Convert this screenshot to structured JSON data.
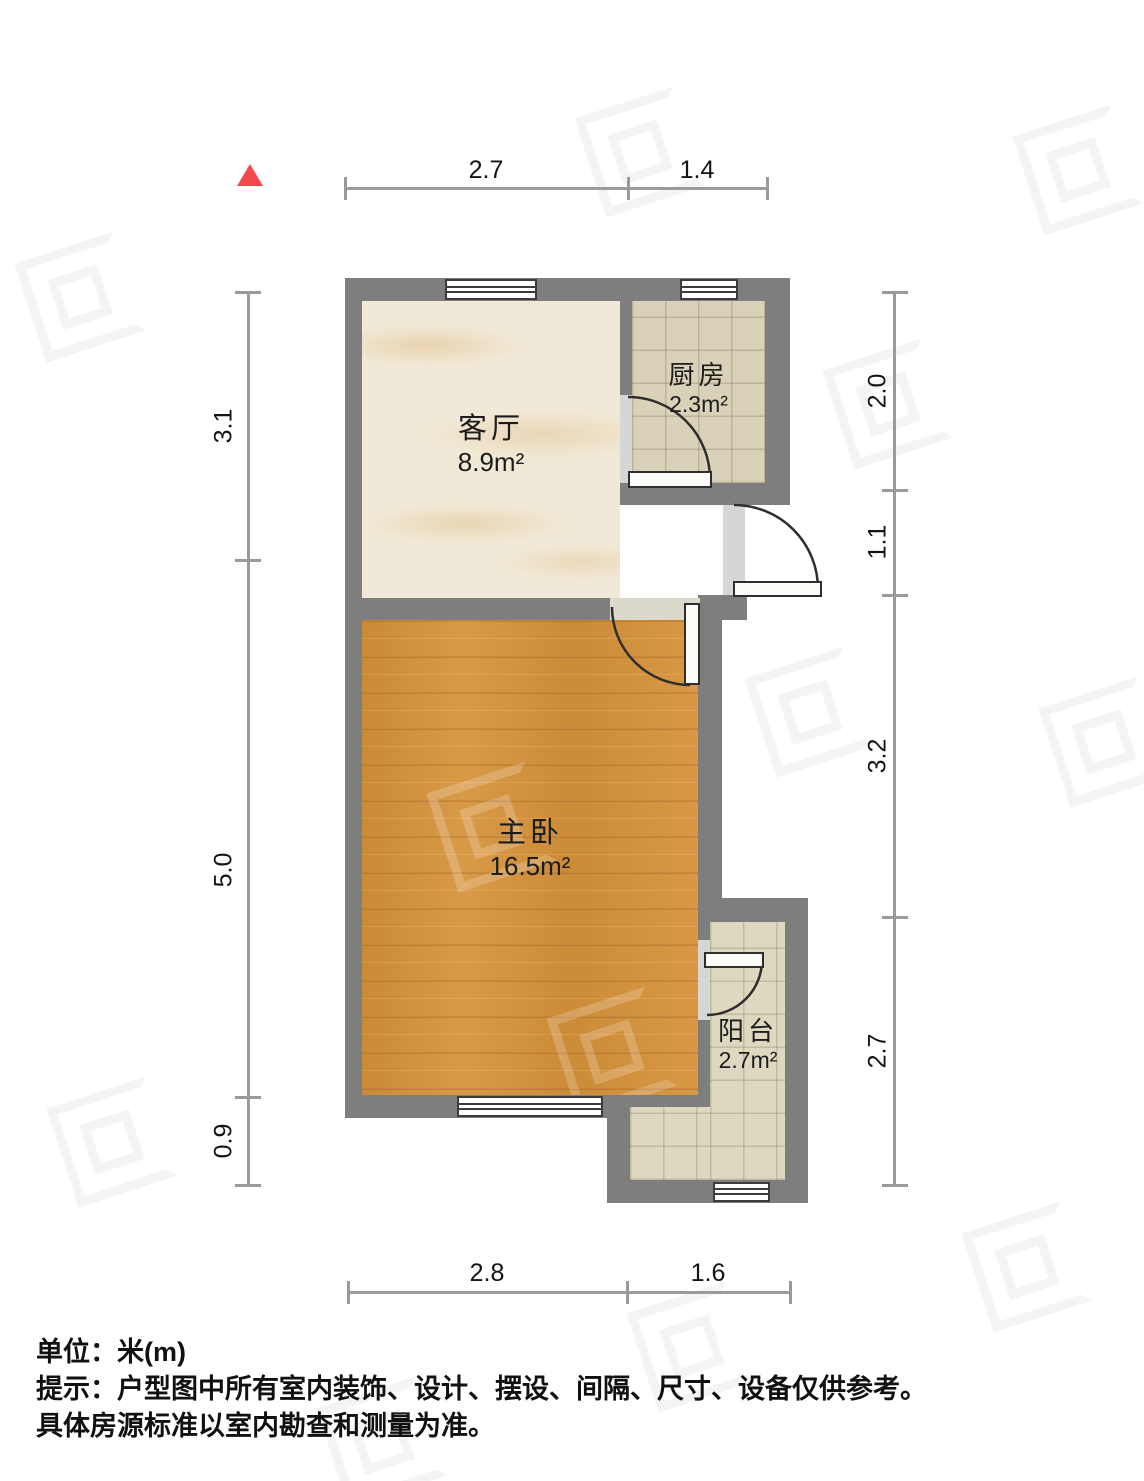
{
  "plan": {
    "rooms": {
      "living": {
        "name": "客厅",
        "area": "8.9m²"
      },
      "kitchen": {
        "name": "厨房",
        "area": "2.3m²"
      },
      "bedroom": {
        "name": "主卧",
        "area": "16.5m²"
      },
      "balcony": {
        "name": "阳台",
        "area": "2.7m²"
      }
    },
    "dims": {
      "top": [
        "2.7",
        "1.4"
      ],
      "bottom": [
        "2.8",
        "1.6"
      ],
      "left": [
        "3.1",
        "5.0",
        "0.9"
      ],
      "right": [
        "2.0",
        "1.1",
        "3.2",
        "2.7"
      ]
    },
    "colors": {
      "wall": "#7e7e7e",
      "dimension_line": "#9a9a9a",
      "north_arrow": "#f2484b",
      "living_floor": "#f1e9d7",
      "kitchen_floor": "#d9d2b8",
      "bedroom_floor": "#d6923a",
      "balcony_floor": "#ded8c1"
    }
  },
  "footer": {
    "unit": "单位：米(m)",
    "tip1": "提示：户型图中所有室内装饰、设计、摆设、间隔、尺寸、设备仅供参考。",
    "tip2": "具体房源标准以室内勘查和测量为准。"
  }
}
